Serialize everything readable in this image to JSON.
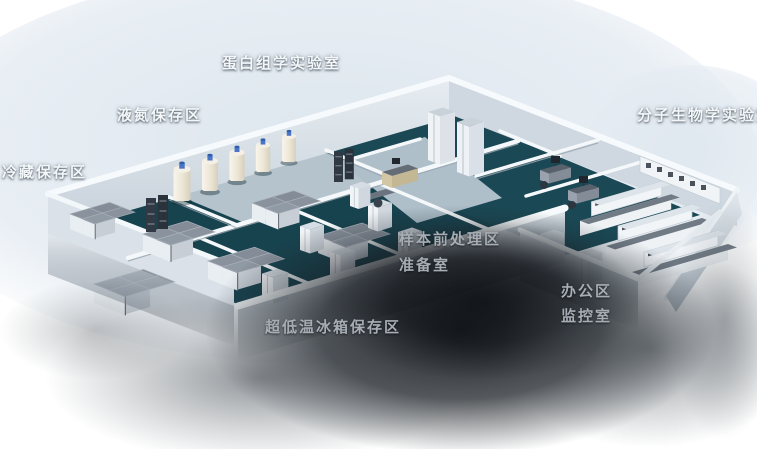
{
  "labels": [
    {
      "id": "proteomics-lab",
      "text": "蛋白组学实验室",
      "tone": "bright"
    },
    {
      "id": "liquid-nitrogen-storage",
      "text": "液氮保存区",
      "tone": "bright"
    },
    {
      "id": "cold-storage",
      "text": "冷藏保存区",
      "tone": "bright"
    },
    {
      "id": "molecular-biology-lab",
      "text": "分子生物学实验室",
      "tone": "bright"
    },
    {
      "id": "sample-pretreatment-area",
      "text": "样本前处理区",
      "tone": "dim"
    },
    {
      "id": "preparation-room",
      "text": "准备室",
      "tone": "dim"
    },
    {
      "id": "office-area",
      "text": "办公区",
      "tone": "dim"
    },
    {
      "id": "monitoring-room",
      "text": "监控室",
      "tone": "dim"
    },
    {
      "id": "ult-freezer-storage",
      "text": "超低温冰箱保存区",
      "tone": "dim"
    }
  ],
  "palette": {
    "background": "#ffffff",
    "backdrop_wash": "#dfe7ee",
    "floor_dark_teal": "#17434f",
    "floor_light": "#b5c3cd",
    "wall_white": "#f4f8fa",
    "wall_shade": "#cdd6de",
    "freezer_gray": "#8a929d",
    "tank_body": "#efe9da",
    "tank_cap": "#3f6fc0",
    "bench_top": "#717b85",
    "shadow": "#0c0f13",
    "label_bright": "#f3f7f9",
    "label_dim": "#a6adb5"
  }
}
